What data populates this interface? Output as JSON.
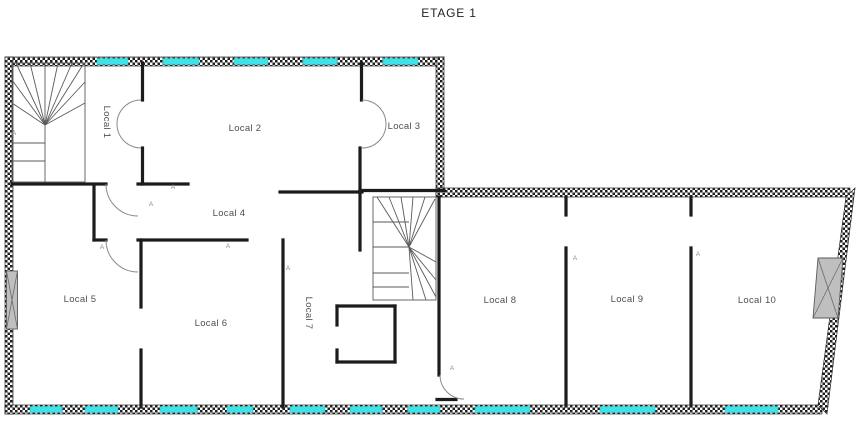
{
  "title": "ETAGE 1",
  "marker_label": "A",
  "rooms": [
    {
      "id": "local-1",
      "label": "Local 1"
    },
    {
      "id": "local-2",
      "label": "Local 2"
    },
    {
      "id": "local-3",
      "label": "Local 3"
    },
    {
      "id": "local-4",
      "label": "Local 4"
    },
    {
      "id": "local-5",
      "label": "Local 5"
    },
    {
      "id": "local-6",
      "label": "Local 6"
    },
    {
      "id": "local-7",
      "label": "Local 7"
    },
    {
      "id": "local-8",
      "label": "Local 8"
    },
    {
      "id": "local-9",
      "label": "Local 9"
    },
    {
      "id": "local-10",
      "label": "Local 10"
    }
  ],
  "colors": {
    "window": "#3fe2e6",
    "wall_hatch": "#1f1f1f",
    "interior_wall": "#1c1c1c",
    "shaft_fill": "#bfbfbf",
    "label_text": "#4f4f4f"
  }
}
